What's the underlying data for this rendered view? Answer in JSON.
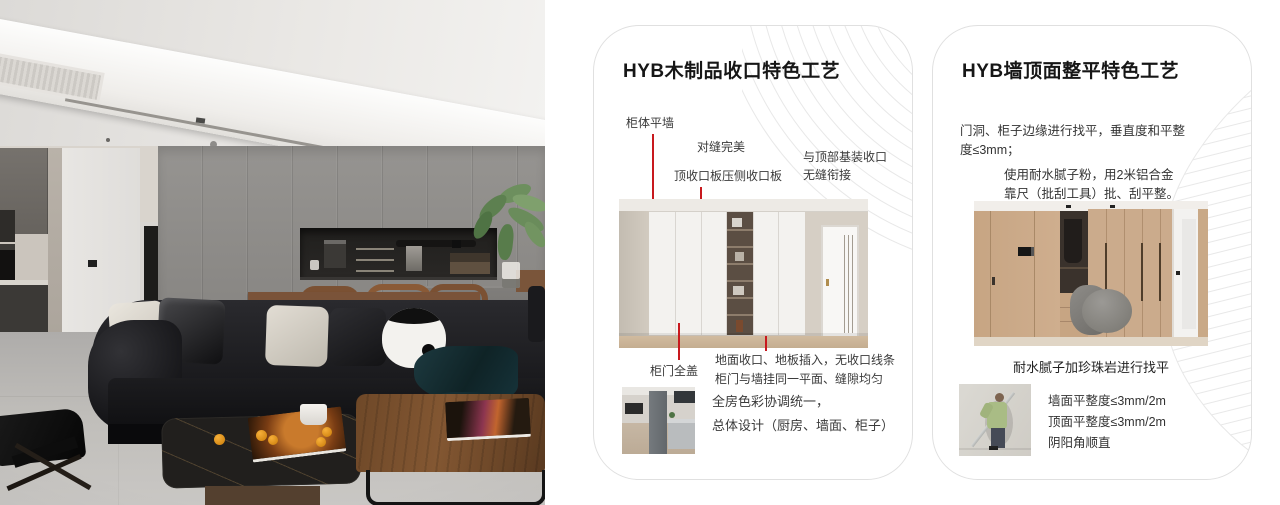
{
  "colors": {
    "accent-red": "#c8191e",
    "card-border": "#e0e0e0",
    "deco-line": "#e8e8e8"
  },
  "card1": {
    "title": "HYB木制品收口特色工艺",
    "callout_cabinet_wall": "柜体平墙",
    "callout_seam": "对缝完美",
    "callout_top_board": "顶收口板压侧收口板",
    "callout_top_joint_1": "与顶部基装收口",
    "callout_top_joint_2": "无缝衔接",
    "callout_door_cover": "柜门全盖",
    "callout_floor_1": "地面收口、地板插入，无收口线条",
    "callout_floor_2": "柜门与墙挂同一平面、缝隙均匀",
    "note_1": "全房色彩协调统一，",
    "note_2": "总体设计（厨房、墙面、柜子）"
  },
  "card2": {
    "title": "HYB墙顶面整平特色工艺",
    "para1_1": "门洞、柜子边缘进行找平，垂直度和平整",
    "para1_2": "度≤3mm；",
    "para2_1": "使用耐水腻子粉，用2米铝合金",
    "para2_2": "靠尺（批刮工具）批、刮平整。",
    "caption": "耐水腻子加珍珠岩进行找平",
    "spec_1": "墙面平整度≤3mm/2m",
    "spec_2": "顶面平整度≤3mm/2m",
    "spec_3": "阴阳角顺直"
  }
}
